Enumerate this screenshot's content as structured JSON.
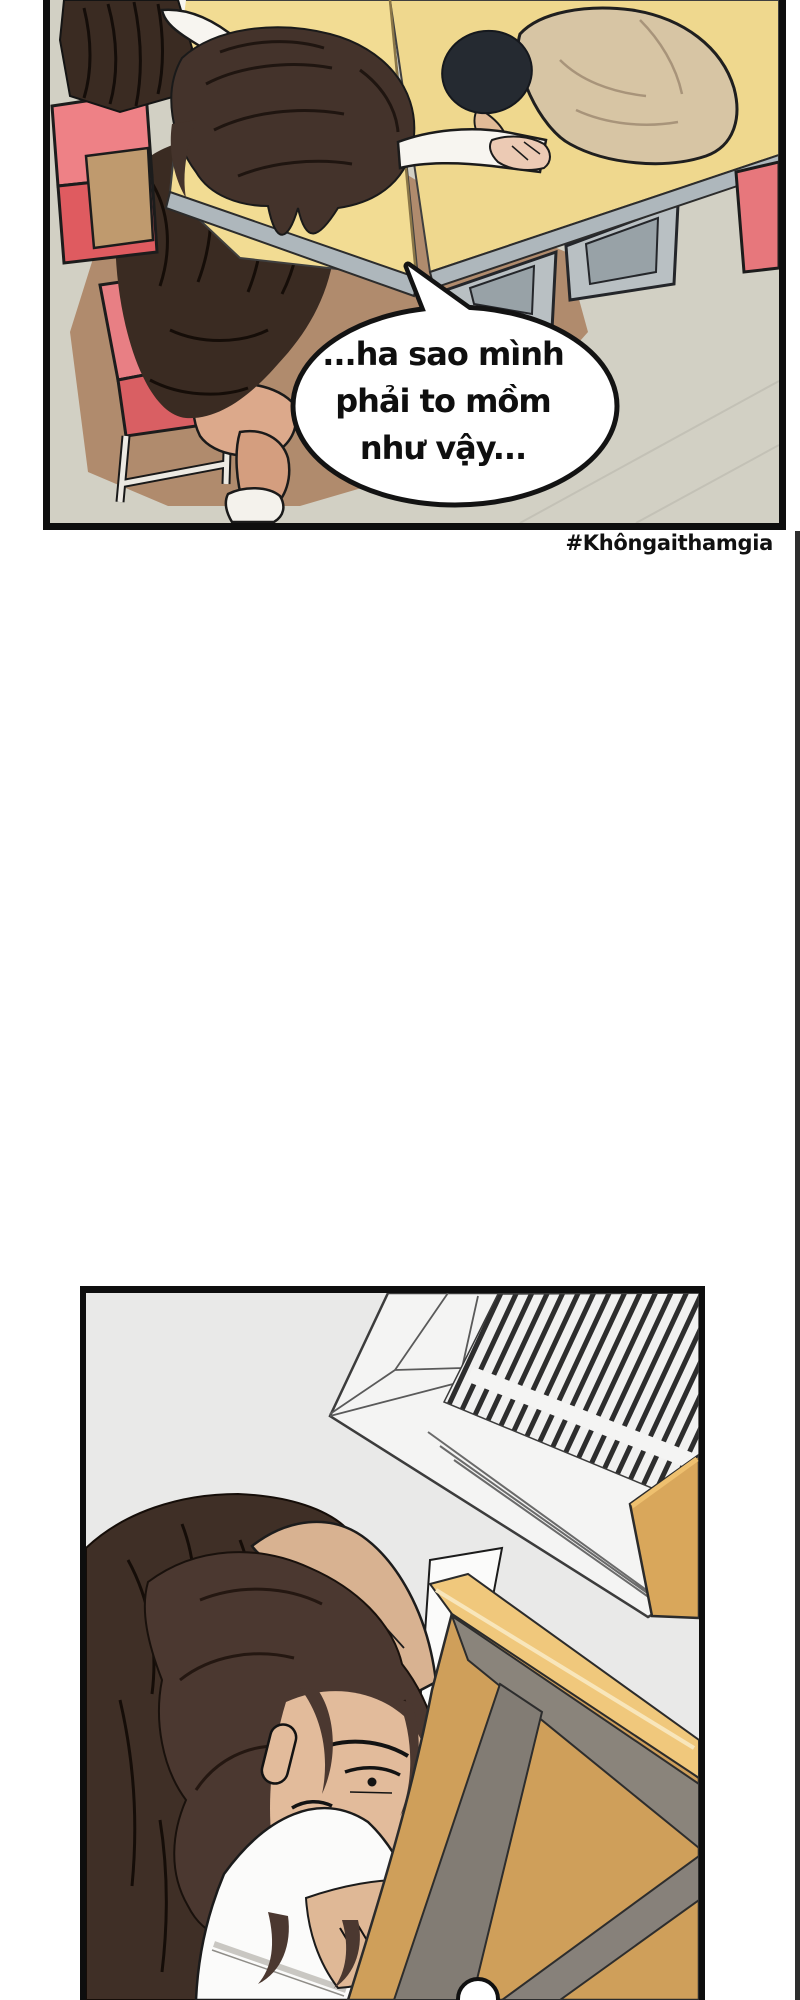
{
  "page": {
    "width": 800,
    "height": 2000,
    "background": "#ffffff"
  },
  "panel_classroom": {
    "scene": "Two students slumped asleep on joined school desks, seen from above",
    "speech_bubble": {
      "lines": [
        "...ha sao mình",
        "phải to mồm",
        "như vậy..."
      ]
    }
  },
  "caption": {
    "hashtag": "#Khôngaithamgia"
  },
  "panel_under_desk": {
    "scene": "Girl with long dark hair crouched under a wooden desk below a ceiling air vent, partial speech bubble at bottom"
  },
  "palette": {
    "panel_border": "#0e0e0e",
    "floor_gray": "#d2d0c4",
    "floor_brown": "#b08b6d",
    "desk_yellow": "#f2dc93",
    "desk_edge_gray": "#aeb7bc",
    "chair_pink": "#ee8186",
    "chair_red": "#df5b60",
    "chair_tan": "#bf9a6e",
    "girl_hair": "#44332b",
    "uniform_dark": "#3a2b22",
    "boy_jacket_tan": "#d7c5a4",
    "boy_hair": "#252a31",
    "skin": "#e2bb9b",
    "panel2_background": "#e9e9e8",
    "vent_white": "#f4f4f3",
    "vent_slat": "#2d2d2d",
    "wood": "#cf9f5a",
    "wood_light_edge": "#f0c87c",
    "frame_gray": "#8a847b",
    "bubble_fill": "#ffffff",
    "text_color": "#111111"
  }
}
